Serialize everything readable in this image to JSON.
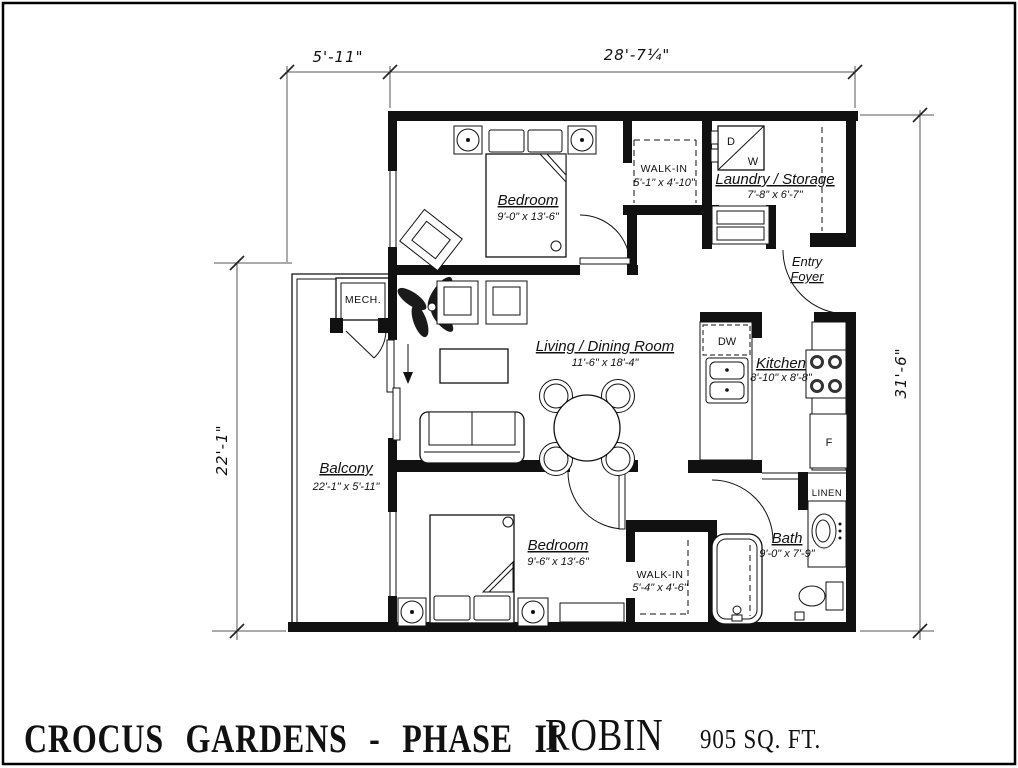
{
  "title_block": {
    "project_name": "CROCUS GARDENS - PHASE II",
    "unit_name": "ROBIN",
    "unit_area": "905 SQ. FT."
  },
  "dimension_labels": {
    "balcony_width": "5'-11\"",
    "unit_width": "28'-7¼\"",
    "balcony_length": "22'-1\"",
    "unit_depth": "31'-6\""
  },
  "rooms": {
    "bedroom_top": {
      "name": "Bedroom",
      "size": "9'-0\" x 13'-6\""
    },
    "walk_in_top": {
      "name": "WALK-IN",
      "size": "5'-1\" x 4'-10\""
    },
    "laundry_storage": {
      "name": "Laundry / Storage",
      "size": "7'-8\" x 6'-7\""
    },
    "entry_foyer": {
      "name_line1": "Entry",
      "name_line2": "Foyer"
    },
    "living_dining": {
      "name": "Living / Dining Room",
      "size": "11'-6\" x 18'-4\""
    },
    "kitchen": {
      "name": "Kitchen",
      "size": "8'-10\" x 8'-8\""
    },
    "balcony": {
      "name": "Balcony",
      "size": "22'-1\" x 5'-11\""
    },
    "bedroom_bottom": {
      "name": "Bedroom",
      "size": "9'-6\" x 13'-6\""
    },
    "walk_in_bottom": {
      "name": "WALK-IN",
      "size": "5'-4\" x 4'-6\""
    },
    "bath": {
      "name": "Bath",
      "size": "9'-0\" x 7'-9\""
    },
    "linen_closet": {
      "name": "LINEN"
    },
    "mech_closet": {
      "name": "MECH."
    }
  },
  "appliance_labels": {
    "dryer": "D",
    "washer": "W",
    "dishwasher": "DW",
    "fridge": "F"
  },
  "colors": {
    "line": "#111111",
    "background": "#ffffff"
  }
}
